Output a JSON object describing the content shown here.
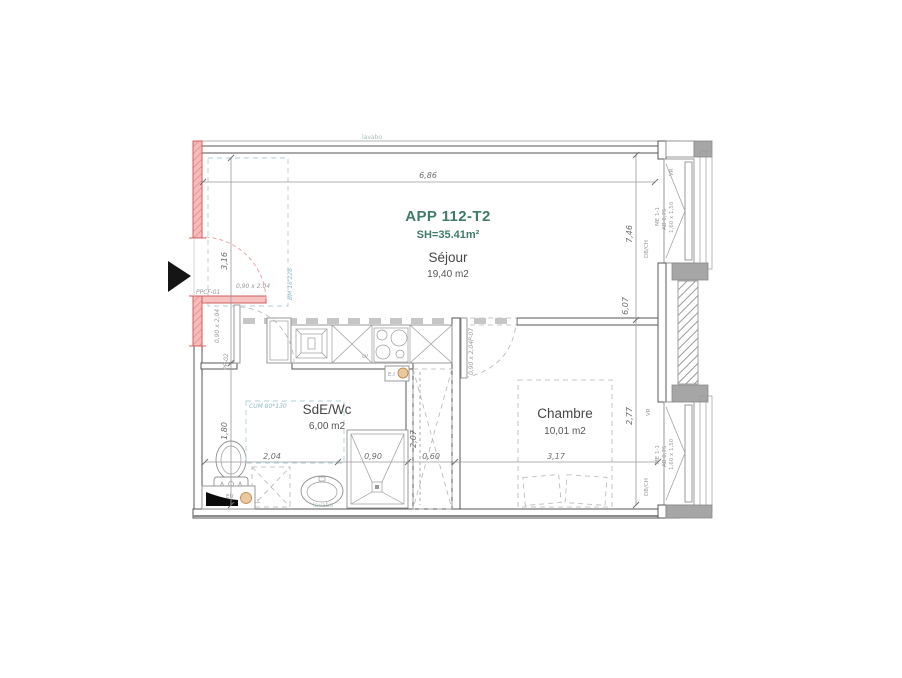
{
  "meta": {
    "app_title": "APP 112-T2",
    "surface": "SH=35.41m²"
  },
  "rooms": {
    "sejour": {
      "name": "Séjour",
      "area": "19,40 m2"
    },
    "sde_wc": {
      "name": "SdE/Wc",
      "area": "6,00 m2"
    },
    "chambre": {
      "name": "Chambre",
      "area": "10,01 m2"
    }
  },
  "dimensions": {
    "top_width": "6,86",
    "entry_height": "3,16",
    "bath_height": "1,80",
    "right_total": "7,46",
    "right_sejour": "6,07",
    "right_chambre": "2,77",
    "bottom_bath": "2,04",
    "bottom_shower": "0,90",
    "bottom_duct": "0,60",
    "bottom_chambre": "3,17",
    "duct_height": "2,07"
  },
  "doors": {
    "entry": {
      "ref": "PPCF-01",
      "size": "0,90 x 2,04"
    },
    "bathroom": {
      "ref": "PP-02",
      "size": "0,90 x 2,04"
    },
    "bedroom": {
      "ref": "P-07",
      "size": "0,90 x 2,04"
    }
  },
  "windows": {
    "upper": {
      "shutter": "VR",
      "ref": "ME 1-1",
      "sill": "AB 0,75",
      "size": "1,60 x 1,50",
      "glazing": "DB/CH"
    },
    "lower": {
      "shutter": "VR",
      "ref": "ME 1-1",
      "sill": "AB 0,75",
      "size": "1,60 x 1,50",
      "glazing": "DB/CH"
    }
  },
  "annotations": {
    "sink_top": "lavabo",
    "basin": "lavabo",
    "bm_zone": "BM 18'228",
    "cum_zone": "CUM 80*130",
    "washing_machine": "LL",
    "dishwasher": "LV",
    "waste_duct": "EU",
    "fire_box": "E.I"
  },
  "colors": {
    "teal_text": "#3f7a6b",
    "red_wall_fill": "#f6bcbc",
    "red_wall_stroke": "#cf5f5f",
    "wall_stroke": "#565656",
    "gray_block": "#a6a6a6",
    "teal_dashed": "#aed0d8",
    "dim_text": "#6e6e6e",
    "duct_circle": "#eac9a0"
  }
}
